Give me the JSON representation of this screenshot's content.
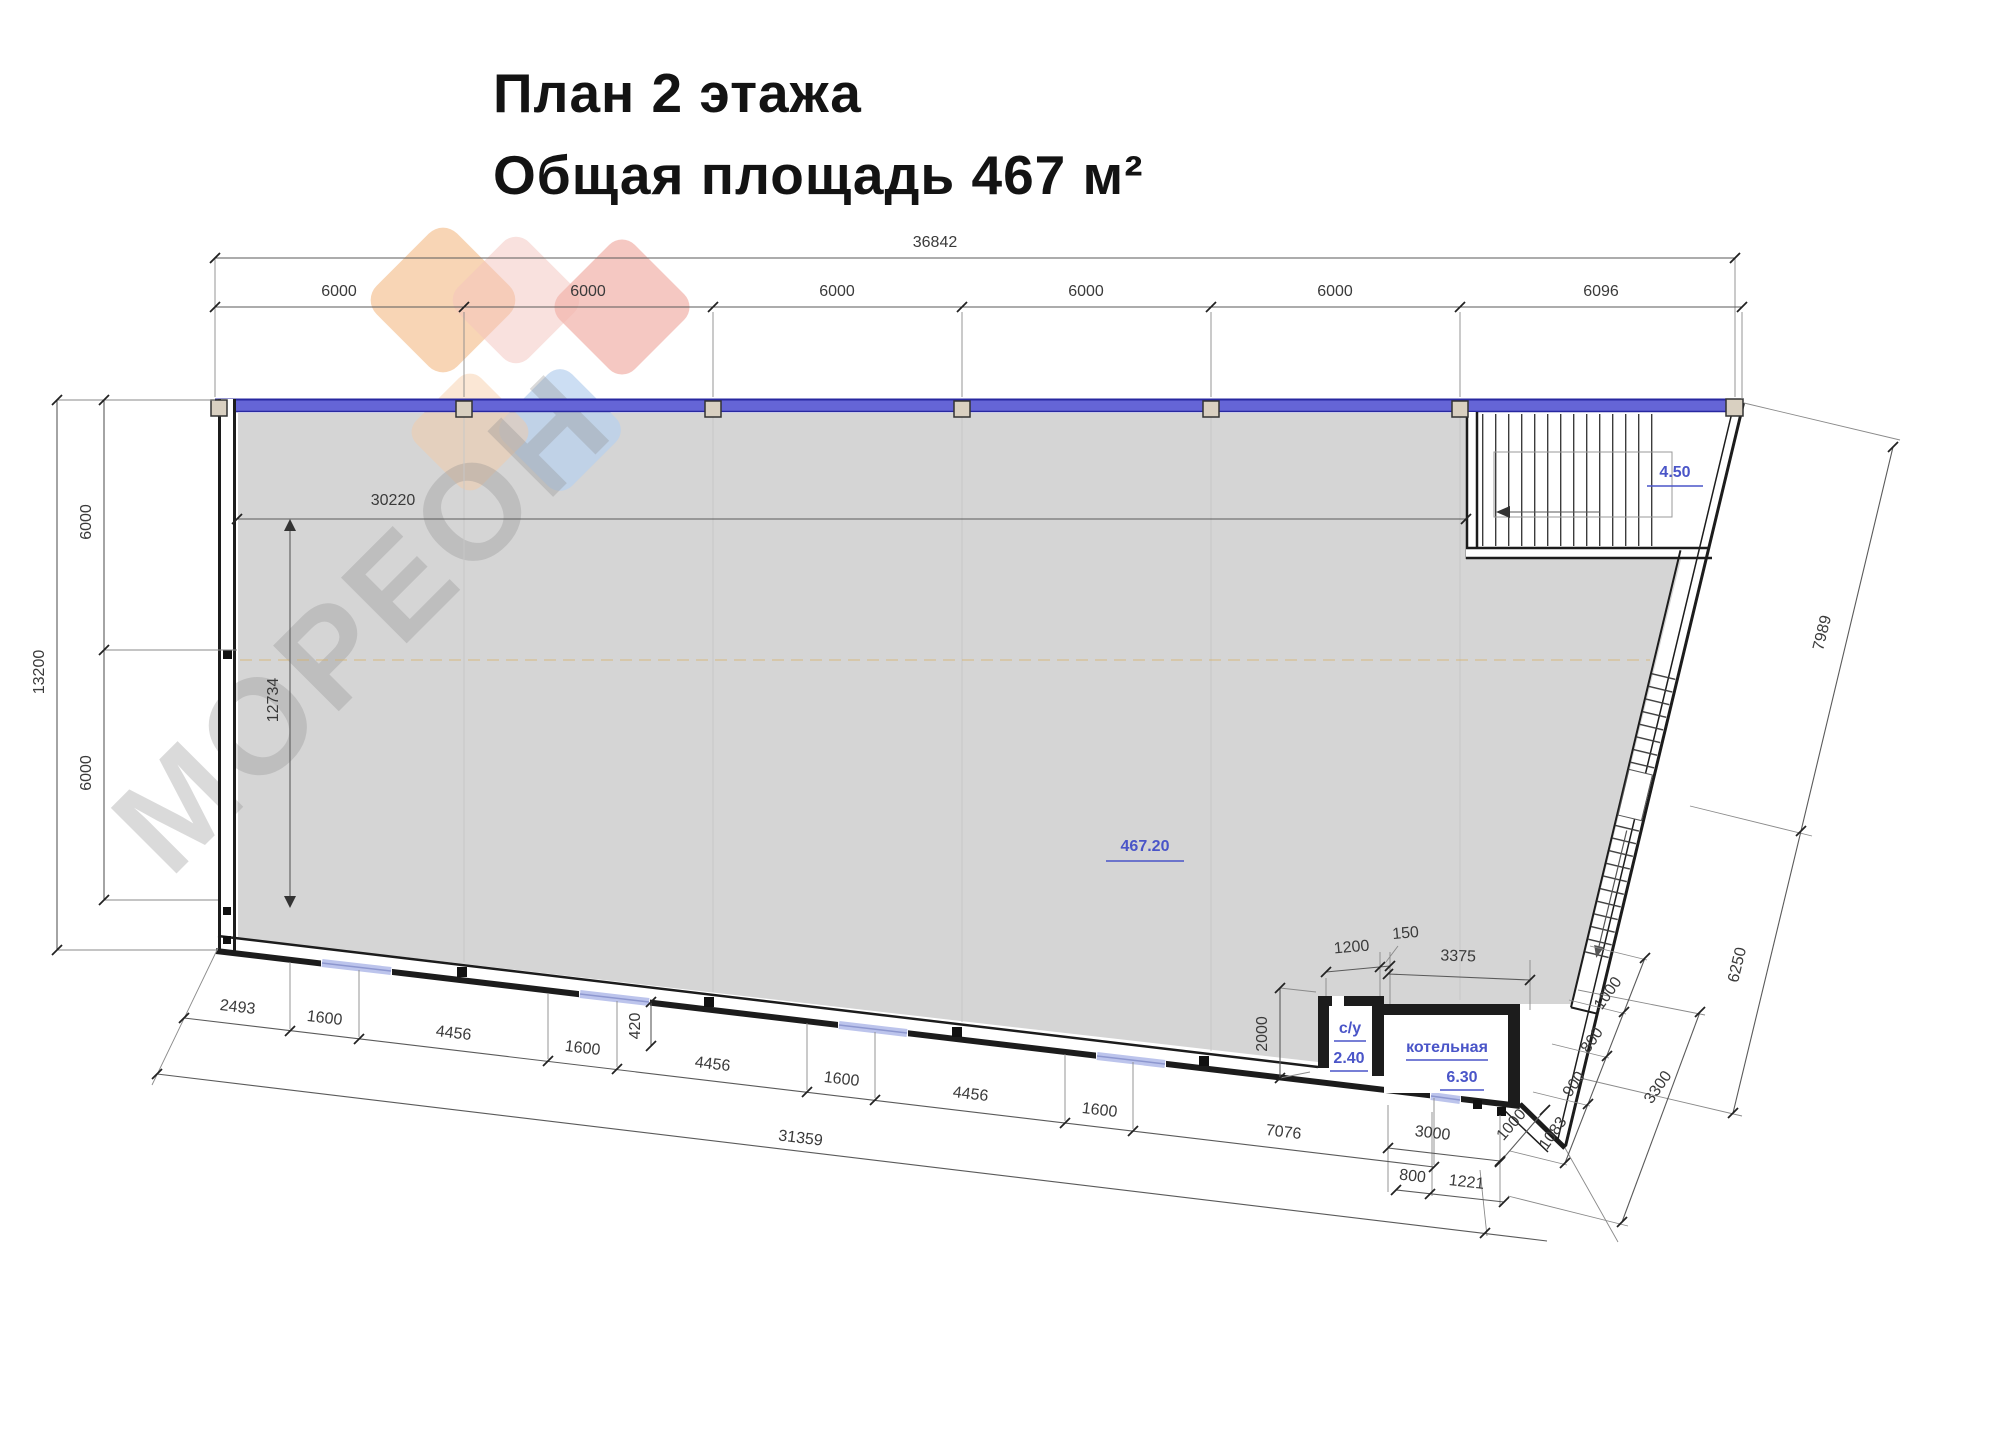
{
  "title": {
    "line1": "План 2 этажа",
    "line2": "Общая площадь 467 м²"
  },
  "watermark": {
    "text": "МОРЕОН"
  },
  "colors": {
    "accent_blue": "#4a55c8",
    "wall_blue": "#6565d6",
    "window_blue": "#bcc4ec",
    "floor_gray": "#d5d5d5",
    "watermark_orange": "#f6caa2",
    "watermark_pink": "#f2b6ae",
    "watermark_blue": "#b7d0ee"
  },
  "plan": {
    "main_area_label": "467.20",
    "stair_area_label": "4.50",
    "rooms": [
      {
        "name": "с/у",
        "area": "2.40"
      },
      {
        "name": "котельная",
        "area": "6.30"
      }
    ],
    "dims": {
      "top_overall": "36842",
      "top_segments": [
        "6000",
        "6000",
        "6000",
        "6000",
        "6000",
        "6096"
      ],
      "left_overall": "13200",
      "left_segments": [
        "6000",
        "6000"
      ],
      "interior_width": "30220",
      "interior_height": "12734",
      "bottom_chain": [
        "2493",
        "1600",
        "4456",
        "1600",
        "4456",
        "1600",
        "4456",
        "1600",
        "7076"
      ],
      "bottom_step": "420",
      "bottom_overall": "31359",
      "bottom_right_chain": [
        "3000",
        "800",
        "1221"
      ],
      "room_width_1": "1200",
      "room_width_2": "150",
      "room_width_3": "3375",
      "room_height": "2000",
      "right_upper": "7989",
      "right_stair": "6250",
      "right_chain": [
        "1000",
        "800",
        "900",
        "1083"
      ],
      "right_overall": "3300",
      "corner_step": "1000"
    }
  }
}
